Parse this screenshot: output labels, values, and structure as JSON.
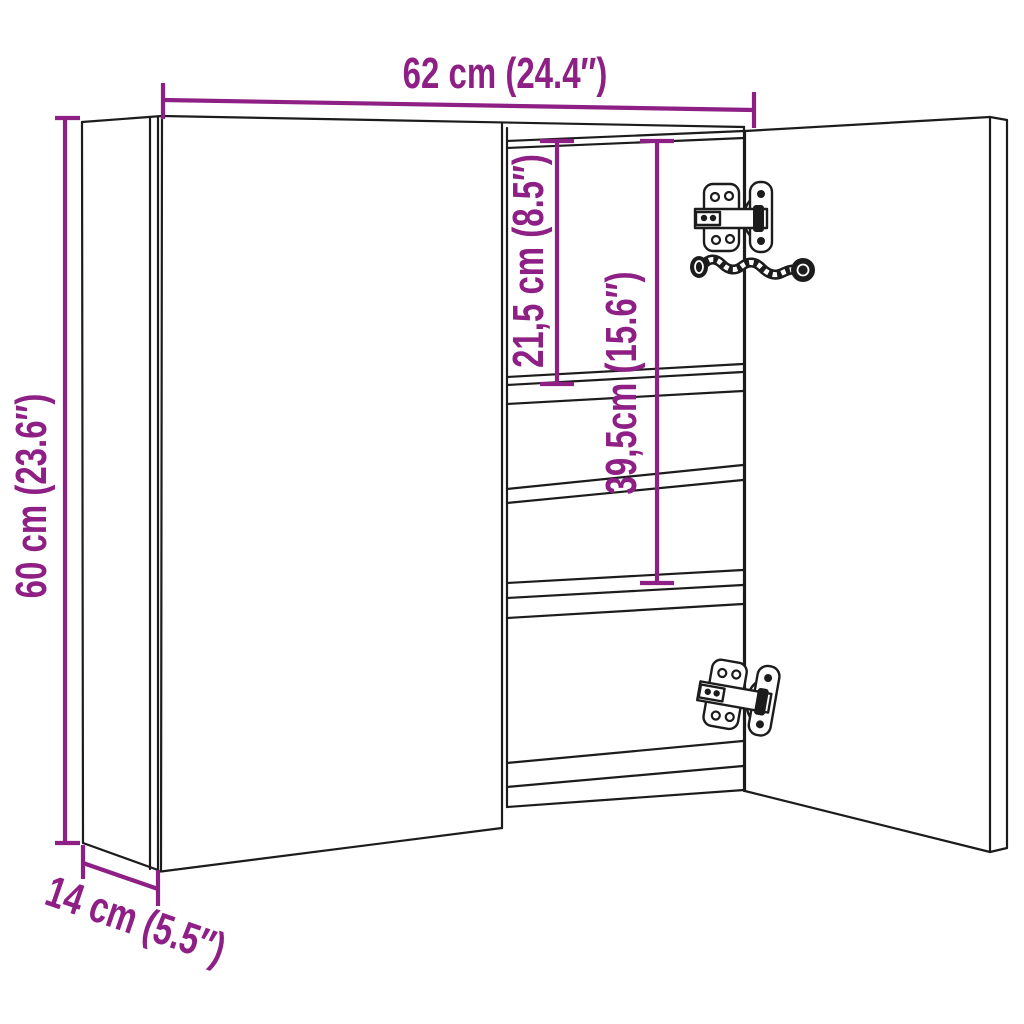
{
  "diagram": {
    "type": "product-dimension-drawing",
    "subject": "wall mirror cabinet with two doors, right door open showing interior shelves and hinges",
    "dimensions": {
      "width": "62 cm (24.4″)",
      "height": "60 cm (23.6″)",
      "depth": "14 cm (5.5″)",
      "upper_compartment": "21,5 cm (8.5″)",
      "lower_compartment": "39,5cm (15.6″)"
    },
    "colors": {
      "accent": "#8e1f85",
      "line": "#1c1c1c",
      "background": "#ffffff"
    }
  }
}
